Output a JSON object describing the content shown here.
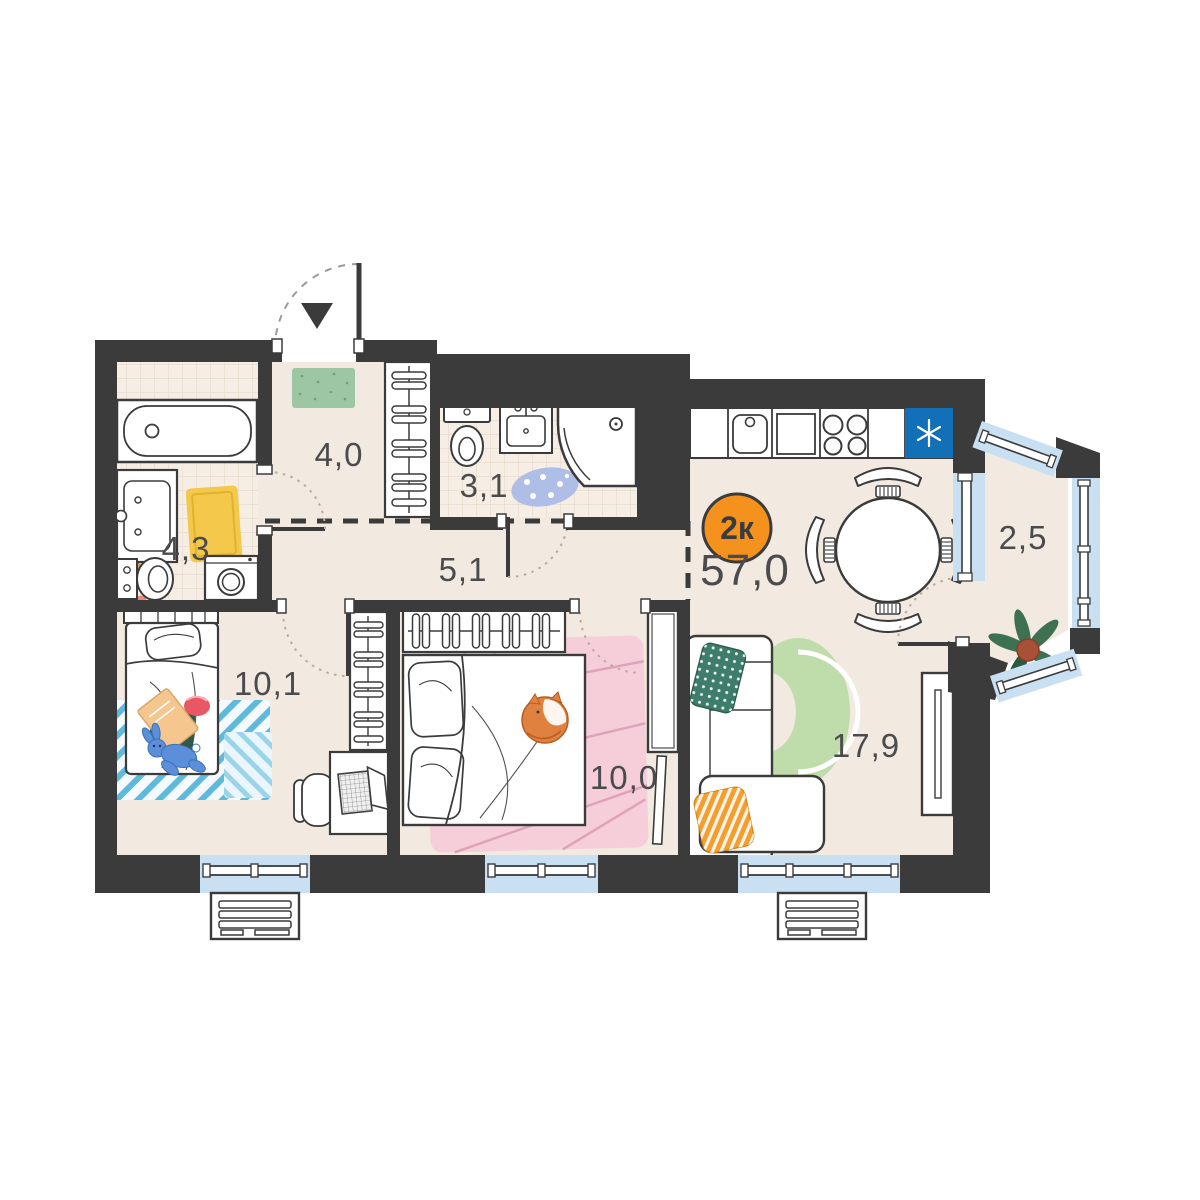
{
  "plan": {
    "badge": {
      "label": "2к",
      "shape": "circle",
      "color": "#F5921E"
    },
    "total_area_label": "57,0",
    "rooms": [
      {
        "id": "entry-hall",
        "area_label": "4,0"
      },
      {
        "id": "bathroom",
        "area_label": "4,3"
      },
      {
        "id": "wc-shower",
        "area_label": "3,1"
      },
      {
        "id": "hallway",
        "area_label": "5,1"
      },
      {
        "id": "bedroom-child",
        "area_label": "10,1"
      },
      {
        "id": "bedroom",
        "area_label": "10,0"
      },
      {
        "id": "kitchen-living-room",
        "area_label": "17,9"
      },
      {
        "id": "balcony",
        "area_label": "2,5"
      }
    ],
    "icons": {
      "entry_arrow": "triangle-down",
      "fridge": "snowflake-asterisk"
    },
    "colors": {
      "wall": "#3B3B3C",
      "floor": "#F2E9E0",
      "tile": "#F6EDE4",
      "window": "#C9E0F2",
      "accent_orange": "#F5921E",
      "fridge_blue": "#1170B8"
    }
  }
}
